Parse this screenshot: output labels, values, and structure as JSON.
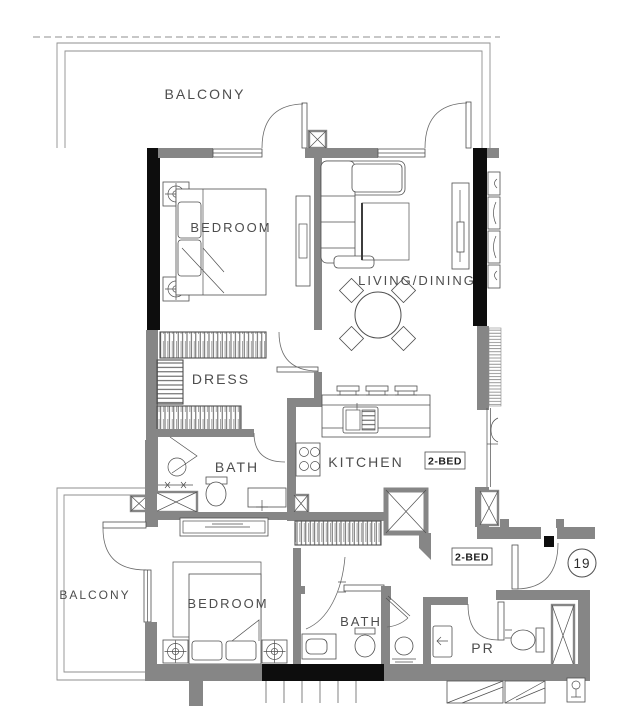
{
  "title": "2-BED unit 19 floor plan",
  "colors": {
    "wall-gray": "#868686",
    "wall-dark": "#0d0d0d",
    "line": "#4f4f4f",
    "line-light": "#8f8f8f",
    "text": "#4d4d4d",
    "bg": "#ffffff"
  },
  "labels": {
    "balcony_top": "BALCONY",
    "bedroom_1": "BEDROOM",
    "living_dining": "LIVING/DINING",
    "dress": "DRESS",
    "bath_1": "BATH",
    "kitchen": "KITCHEN",
    "unit_tag_upper": "2-BED",
    "unit_tag_lower": "2-BED",
    "balcony_bottom": "BALCONY",
    "bedroom_2": "BEDROOM",
    "bath_2": "BATH",
    "powder_room": "PR",
    "unit_number": "19"
  }
}
